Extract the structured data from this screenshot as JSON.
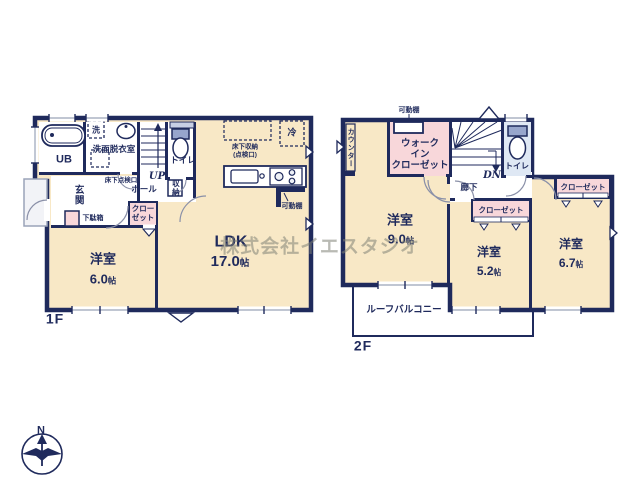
{
  "watermark": {
    "text": "株式会社イエスタジオ"
  },
  "compass": {
    "north": "N"
  },
  "area_unit": "帖",
  "colors": {
    "wall": "#1f2a5c",
    "room_cream": "#f8e8c6",
    "closet_pink": "#f8d7da",
    "toilet_blue": "#dfe8f4",
    "tank_blue": "#97a6cc",
    "porch_outline": "#9aa3b8",
    "watermark_gray": "#82857c"
  },
  "floor1": {
    "label": "1F",
    "unit_bath": "UB",
    "washer": "洗",
    "washroom": "洗面脱衣室",
    "toilet": "トイレ",
    "stairs_up": "UP",
    "hall": "ホール",
    "storage": "収納",
    "underfloor_hatch": "床下点検口",
    "entrance": "玄関",
    "shoe_cabinet": "下駄箱",
    "closet": "クロー\nゼット",
    "ldk": "LDK",
    "ldk_area": "17.0",
    "underfloor_storage": "床下収納\n(点検口)",
    "fridge": "冷",
    "movable_shelf": "可動棚",
    "bedroom": "洋室",
    "bedroom_area": "6.0"
  },
  "floor2": {
    "label": "2F",
    "counter": "カウンター",
    "movable_shelf": "可動棚",
    "walk_in_closet": "ウォーク\nイン\nクローゼット",
    "stairs_down": "DN",
    "toilet": "トイレ",
    "hallway": "廊下",
    "closet_mid": "クローゼット",
    "closet_right": "クローゼット",
    "bedroom1": "洋室",
    "bedroom1_area": "9.0",
    "bedroom2": "洋室",
    "bedroom2_area": "5.2",
    "bedroom3": "洋室",
    "bedroom3_area": "6.7",
    "roof_balcony": "ルーフバルコニー"
  }
}
